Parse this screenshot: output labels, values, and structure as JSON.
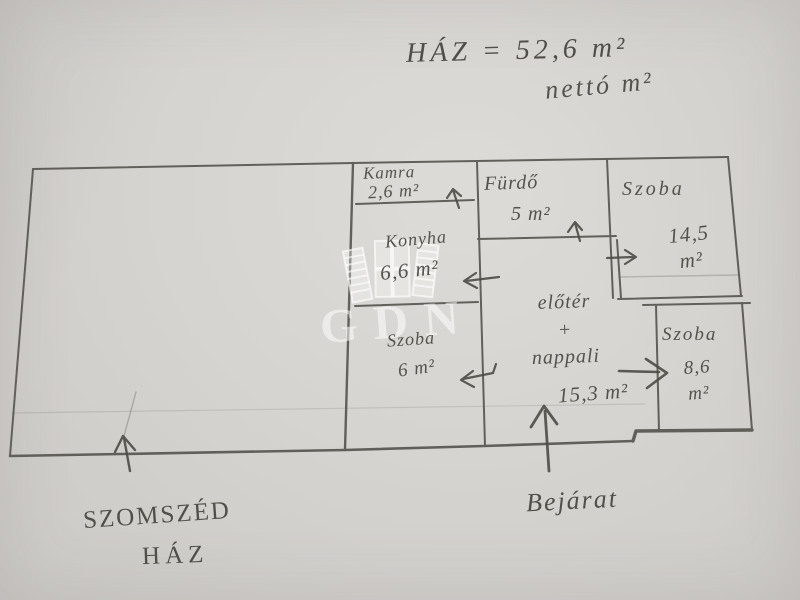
{
  "photo": {
    "paper_color": "#d6d4d0",
    "pencil_color": "#52504b",
    "watermark_color": "rgba(255,255,255,0.52)"
  },
  "title": {
    "house_total": "HÁZ = 52,6 m²",
    "netto_note": "nettó m²"
  },
  "watermark": {
    "text": "GDN",
    "logo": "open-book-logo"
  },
  "rooms": [
    {
      "id": "kamra",
      "name": "Kamra",
      "area": "2,6 m²"
    },
    {
      "id": "furdo",
      "name": "Fürdő",
      "area": "5 m²"
    },
    {
      "id": "szoba-nagy",
      "name": "Szoba",
      "area": "14,5\nm²"
    },
    {
      "id": "konyha",
      "name": "Konyha",
      "area": "6,6 m²"
    },
    {
      "id": "szoba-kis",
      "name": "Szoba",
      "area": "6 m²"
    },
    {
      "id": "eloter-nappali",
      "name": "előtér\n+\nnappali",
      "area": "15,3 m²"
    },
    {
      "id": "szoba-jobb",
      "name": "Szoba",
      "area": "8,6\nm²"
    }
  ],
  "annotations": {
    "entrance": "Bejárat",
    "neighbor_house_line1": "SZOMSZÉD",
    "neighbor_house_line2": "HÁZ"
  },
  "icons": {
    "kamra_door_arrow": "up-arrow",
    "furdo_door_arrow": "up-arrow",
    "szoba_nagy_door_arrow": "right-arrow",
    "konyha_door_arrow": "left-arrow",
    "szoba_kis_door_arrow": "left-arrow",
    "szoba_jobb_door_arrow": "right-arrow",
    "entrance_arrow": "up-arrow",
    "neighbor_arrow": "up-arrow",
    "watermark_logo": "open-book-logo"
  }
}
